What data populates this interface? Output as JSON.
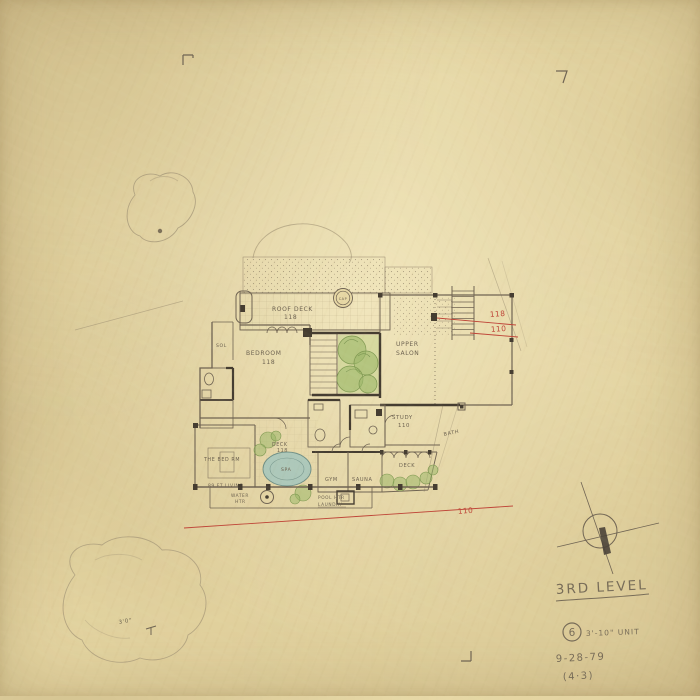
{
  "colors": {
    "paper": "#e7d8a5",
    "pencil": "#6f6453",
    "pencil_dark": "#453d31",
    "red_ink": "#bf4538",
    "green_wash": "#a9bf72",
    "blue_wash": "#a3c6bd"
  },
  "sheet": {
    "title": "3RD LEVEL",
    "unit_circle": "6",
    "unit_note": "3'-10\" UNIT",
    "date": "9-28-79",
    "sheet_no": "(4·3)",
    "corner_note": "3'0\""
  },
  "plan": {
    "rooms": {
      "roof_deck": "ROOF DECK",
      "roof_deck_no": "118",
      "cap": "CAP",
      "sol": "SOL",
      "bedroom": "BEDROOM",
      "bedroom_no": "118",
      "upper_salon_1": "UPPER",
      "upper_salon_2": "SALON",
      "study": "STUDY",
      "study_no": "110",
      "bath": "BATH",
      "deck_right": "DECK",
      "deck_center": "DECK",
      "deck_center_no": "118",
      "spa": "SPA",
      "gym": "GYM",
      "sauna": "SAUNA",
      "bed_rm": "THE BED RM",
      "living_note": "89 FT LIVING",
      "water_htr_1": "WATER",
      "water_htr_2": "HTR",
      "pool_htr": "POOL HTR",
      "laundry": "LAUNDRY"
    },
    "redline": {
      "no_118": "118",
      "no_110_upper": "110",
      "no_110_lower": "110"
    }
  }
}
